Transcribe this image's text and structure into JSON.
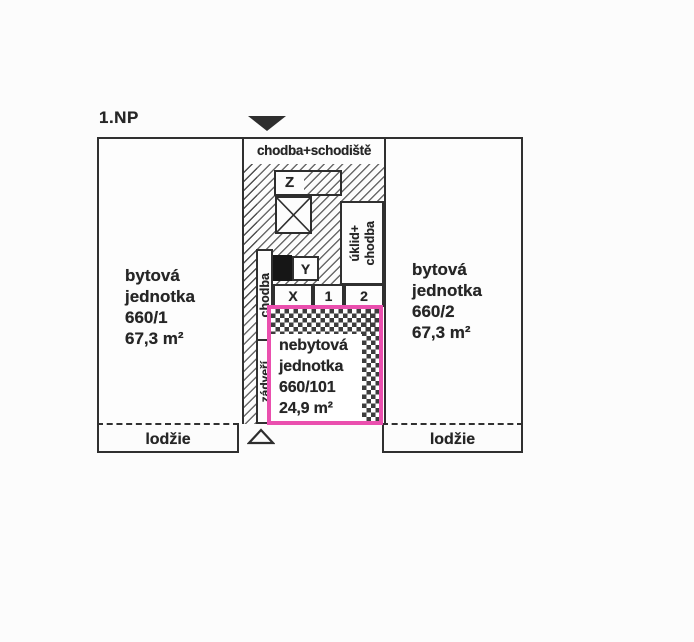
{
  "colors": {
    "ink": "#303030",
    "highlight_pink": "#ea4fae",
    "paper": "#fcfcfc"
  },
  "floor_label": "1.NP",
  "plan": {
    "unit_left": {
      "lines": [
        "bytová",
        "jednotka",
        "660/1",
        "67,3 m²"
      ]
    },
    "unit_right": {
      "lines": [
        "bytová",
        "jednotka",
        "660/2",
        "67,3 m²"
      ]
    },
    "corridor": {
      "header": "chodba+schodiště",
      "stair_top_label": "Z",
      "y_label": "Y",
      "box_x": "X",
      "box_1": "1",
      "box_2": "2",
      "hall_label": "chodba",
      "vestibule_label": "zádveří",
      "utility_line1": "úklid+",
      "utility_line2": "chodba"
    },
    "unit_nonres": {
      "lines": [
        "nebytová",
        "jednotka",
        "660/101",
        "24,9 m²"
      ]
    },
    "loggia_left": "lodžie",
    "loggia_right": "lodžie"
  }
}
